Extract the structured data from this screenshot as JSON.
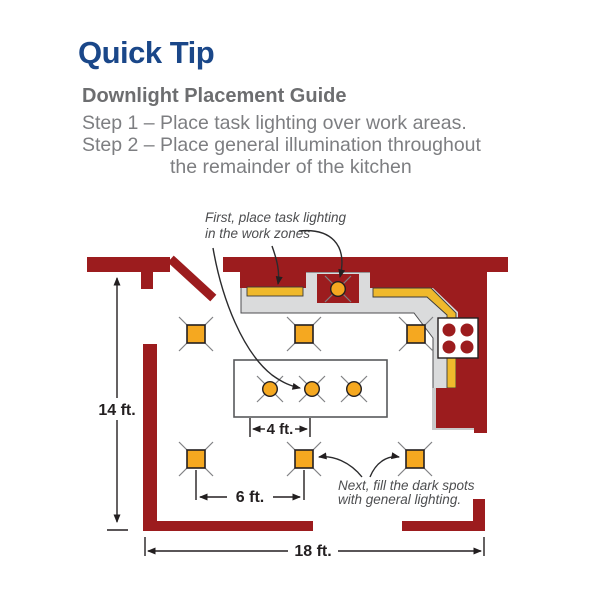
{
  "header": {
    "title": "Quick Tip",
    "subtitle": "Downlight Placement Guide",
    "step1": "Step 1 – Place task lighting over work areas.",
    "step2_line1": "Step 2 – Place general illumination throughout",
    "step2_line2": "the remainder of the kitchen"
  },
  "diagram": {
    "annotation_task": {
      "line1": "First, place task lighting",
      "line2": "in the work zones"
    },
    "annotation_general": {
      "line1": "Next, fill the dark spots",
      "line2": "with general lighting."
    },
    "dimensions": {
      "room_depth": "14 ft.",
      "island_spacing": "4 ft.",
      "general_spacing": "6 ft.",
      "room_width": "18 ft."
    }
  },
  "colors": {
    "title_blue": "#1a4789",
    "heading_gray": "#6d6e70",
    "body_gray": "#7d7e81",
    "wall_red": "#9c1c1e",
    "light_orange": "#f5a820",
    "strip_yellow": "#efb92c",
    "counter_gray": "#dadbdc",
    "line_dark": "#231f20",
    "annotation_gray": "#4d4e50"
  }
}
